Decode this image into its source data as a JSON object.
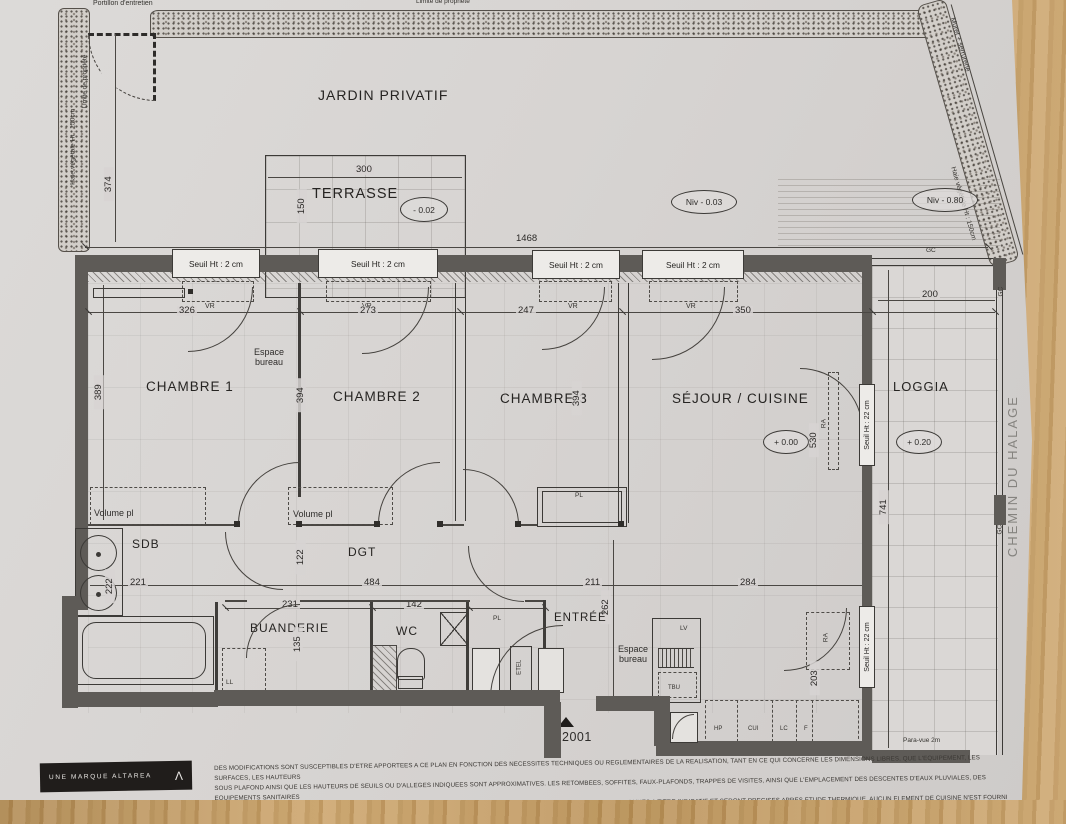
{
  "site": {
    "garden_label": "JARDIN PRIVATIF",
    "portillon": "Portillon d'entretien",
    "limite_propriete": "Limite de propriété",
    "haie": "Haie végétale Ht : 150cm",
    "muret": "Muret + serrurerie",
    "street": "CHEMIN DU HALAGE",
    "garden_depth": "374",
    "niv_garden": "Niv - 0.03",
    "niv_low": "Niv - 0.80"
  },
  "terrace": {
    "label": "TERRASSE",
    "width": "300",
    "depth": "150",
    "level": "- 0.02"
  },
  "facade": {
    "total_width": "1468",
    "seuil_note": "Seuil Ht : 2 cm",
    "vr": "VR",
    "gc": "GC",
    "bay1": "326",
    "bay2": "273",
    "bay3": "247",
    "bay4": "350",
    "bay5": "200"
  },
  "rooms": {
    "ch1": {
      "label": "CHAMBRE 1",
      "depth": "389"
    },
    "ch2": {
      "label": "CHAMBRE 2",
      "depth": "394"
    },
    "ch3": {
      "label": "CHAMBRE 3",
      "depth": "394"
    },
    "sejour": {
      "label": "SÉJOUR / CUISINE",
      "level": "+ 0.00",
      "depth": "530",
      "width_a": "211",
      "width_b": "284"
    },
    "loggia": {
      "label": "LOGGIA",
      "level": "+ 0.20",
      "depth": "741",
      "seuil": "Seuil Ht : 22 cm",
      "paravue": "Para-vue 2m"
    },
    "sdb": {
      "label": "SDB",
      "width": "221",
      "depth": "222"
    },
    "dgt": {
      "label": "DGT",
      "width": "484",
      "depth": "122"
    },
    "buanderie": {
      "label": "BUANDERIE",
      "width": "231",
      "depth": "135"
    },
    "wc": {
      "label": "WC",
      "width": "142"
    },
    "entree": {
      "label": "ENTRÉE",
      "depth": "262"
    },
    "bureau": {
      "line1": "Espace",
      "line2": "bureau"
    },
    "kitchen_depth": "203"
  },
  "fixtures": {
    "volume_pl": "Volume pl",
    "pl": "PL",
    "ll": "LL",
    "lv": "LV",
    "tbu": "TBU",
    "hp": "HP",
    "cui": "CUI",
    "lc": "LC",
    "f": "F",
    "etel": "ETEL",
    "ra": "RA"
  },
  "unit": {
    "number": "N° 2001"
  },
  "footer": {
    "brand": "UNE MARQUE ALTAREA",
    "logo_mark": "Λ",
    "disclaimer": [
      "DES MODIFICATIONS SONT SUSCEPTIBLES D'ETRE APPORTEES A CE PLAN EN FONCTION DES NECESSITES TECHNIQUES OU REGLEMENTAIRES DE LA REALISATION, TANT EN CE QUI CONCERNE LES DIMENSIONS LIBRES, QUE L'EQUIPEMENT, LES SURFACES, LES HAUTEURS",
      "SOUS PLAFOND AINSI QUE LES HAUTEURS DE SEUILS OU D'ALLEGES INDIQUEES SONT APPROXIMATIVES. LES RETOMBEES, SOFFITES, FAUX-PLAFONDS, TRAPPES DE VISITES, AINSI QUE L'EMPLACEMENT DES DESCENTES D'EAUX PLUVIALES, DES EQUIPEMENTS SANITAIRES",
      "NE SONT PAS TOUS FIGURES OU LE SONT A TITRE INDICATIF . LE NOMBRE, LA TAILLE ET L'EMPLACEMENT DES RADIATEURS SONT DONNES A TITRE INDICATIF ET SERONT PRECISES APRES ETUDE THERMIQUE. AUCUN ELEMENT DE CUISINE N'EST FOURNI HORS ACHAT"
    ]
  }
}
